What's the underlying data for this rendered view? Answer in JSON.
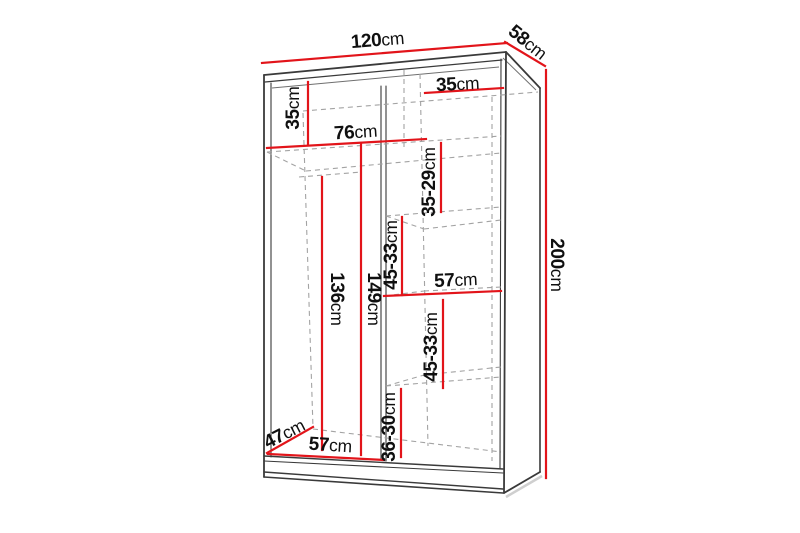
{
  "diagram": {
    "type": "furniture-dimension-diagram",
    "subject": "wardrobe with shelves and hanging sections, perspective view",
    "unit": "cm",
    "colors": {
      "dimension_line": "#e2141a",
      "outline": "#3a3a3a",
      "hidden_edge": "#a3a3a3",
      "label_text": "#101010",
      "background": "#ffffff"
    },
    "labels": {
      "overall_width": {
        "value": "120",
        "unit": "cm"
      },
      "overall_depth": {
        "value": "58",
        "unit": "cm"
      },
      "overall_height": {
        "value": "200",
        "unit": "cm"
      },
      "top_shelf_drop": {
        "value": "35",
        "unit": "cm"
      },
      "right_top_width": {
        "value": "35",
        "unit": "cm"
      },
      "left_width": {
        "value": "76",
        "unit": "cm"
      },
      "right_gap_1": {
        "value": "35-29",
        "unit": "cm"
      },
      "right_gap_2": {
        "value": "45-33",
        "unit": "cm"
      },
      "mid_shelf_width": {
        "value": "57",
        "unit": "cm"
      },
      "left_height_1": {
        "value": "136",
        "unit": "cm"
      },
      "left_height_2": {
        "value": "149",
        "unit": "cm"
      },
      "right_gap_3": {
        "value": "45-33",
        "unit": "cm"
      },
      "right_gap_4": {
        "value": "36-30",
        "unit": "cm"
      },
      "floor_depth": {
        "value": "47",
        "unit": "cm"
      },
      "floor_width": {
        "value": "57",
        "unit": "cm"
      }
    }
  }
}
